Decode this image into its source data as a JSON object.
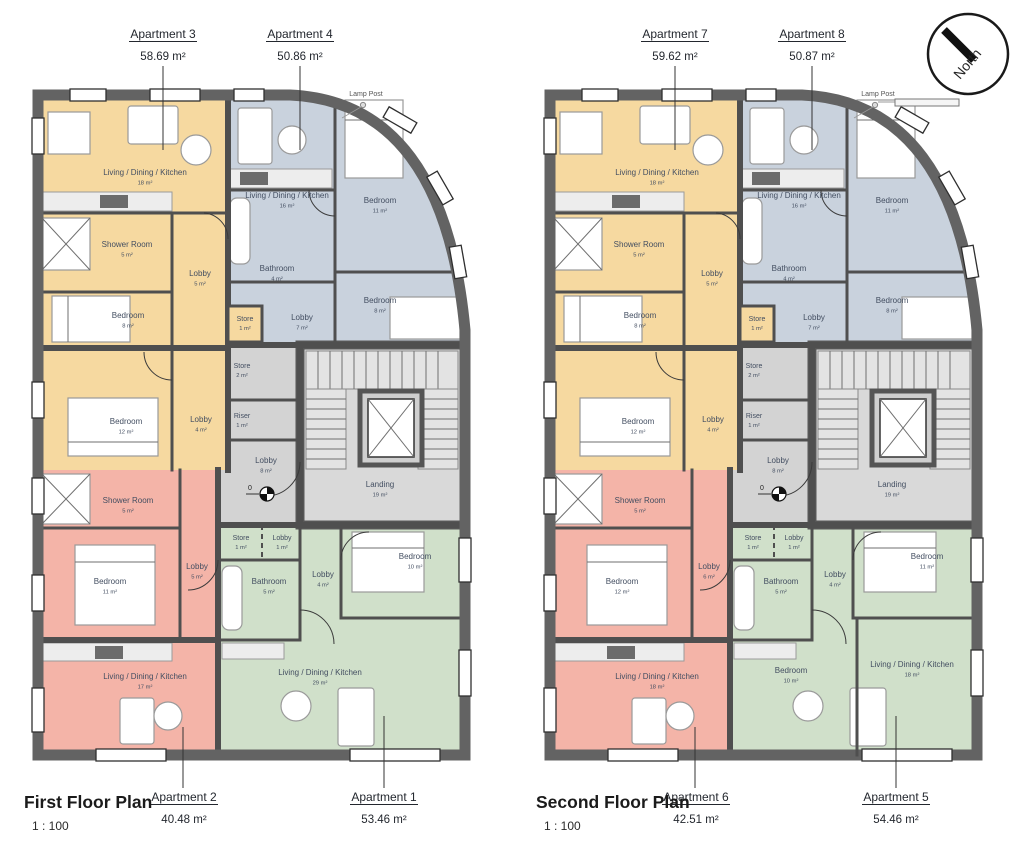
{
  "north_badge": {
    "label": "North"
  },
  "colors": {
    "apartment_yellow": "#F6D9A0",
    "apartment_blue": "#C9D2DD",
    "apartment_red": "#F4B4A8",
    "apartment_green": "#D0E0CA",
    "core_gray": "#D3D3D3",
    "exterior_wall": "#636363",
    "interior_wall": "#4F4F4F",
    "room_label_text": "#434E61",
    "callout_text": "#23272E"
  },
  "plans": [
    {
      "title": "First Floor Plan",
      "scale": "1 : 100",
      "lamp_post": "Lamp Post",
      "level_marker": "0",
      "callouts": {
        "top_left": {
          "name": "Apartment 3",
          "area": "58.69 m²"
        },
        "top_right": {
          "name": "Apartment 4",
          "area": "50.86 m²"
        },
        "bottom_left": {
          "name": "Apartment 2",
          "area": "40.48 m²"
        },
        "bottom_right": {
          "name": "Apartment 1",
          "area": "53.46 m²"
        }
      },
      "rooms": {
        "y_ldk": {
          "name": "Living / Dining / Kitchen",
          "area": "18 m²"
        },
        "y_shower": {
          "name": "Shower Room",
          "area": "5 m²"
        },
        "y_lobby_upper": {
          "name": "Lobby",
          "area": "5 m²"
        },
        "y_bed_small": {
          "name": "Bedroom",
          "area": "8 m²"
        },
        "y_bed_large": {
          "name": "Bedroom",
          "area": "12 m²"
        },
        "y_lobby_lower": {
          "name": "Lobby",
          "area": "4 m²"
        },
        "y_store": {
          "name": "Store",
          "area": "1 m²"
        },
        "b_ldk": {
          "name": "Living / Dining / Kitchen",
          "area": "16 m²"
        },
        "b_bed_front": {
          "name": "Bedroom",
          "area": "11 m²"
        },
        "b_bath": {
          "name": "Bathroom",
          "area": "4 m²"
        },
        "b_bed_rear": {
          "name": "Bedroom",
          "area": "8 m²"
        },
        "b_lobby": {
          "name": "Lobby",
          "area": "7 m²"
        },
        "c_store": {
          "name": "Store",
          "area": "2 m²"
        },
        "c_riser": {
          "name": "Riser",
          "area": "1 m²"
        },
        "c_lobby": {
          "name": "Lobby",
          "area": "8 m²"
        },
        "c_landing": {
          "name": "Landing",
          "area": "19 m²"
        },
        "r_shower": {
          "name": "Shower Room",
          "area": "5 m²"
        },
        "r_bed": {
          "name": "Bedroom",
          "area": "11 m²"
        },
        "r_lobby": {
          "name": "Lobby",
          "area": "5 m²"
        },
        "r_ldk": {
          "name": "Living / Dining / Kitchen",
          "area": "17 m²"
        },
        "g_store": {
          "name": "Store",
          "area": "1 m²"
        },
        "g_lobby_small": {
          "name": "Lobby",
          "area": "1 m²"
        },
        "g_bath": {
          "name": "Bathroom",
          "area": "5 m²"
        },
        "g_lobby": {
          "name": "Lobby",
          "area": "4 m²"
        },
        "g_bed_front": {
          "name": "Bedroom",
          "area": "10 m²"
        },
        "g_ldk_center": {
          "name": "Living / Dining / Kitchen",
          "area": "29 m²"
        }
      }
    },
    {
      "title": "Second Floor Plan",
      "scale": "1 : 100",
      "lamp_post": "Lamp Post",
      "lamp_post_bar": true,
      "level_marker": "0",
      "callouts": {
        "top_left": {
          "name": "Apartment 7",
          "area": "59.62 m²"
        },
        "top_right": {
          "name": "Apartment 8",
          "area": "50.87 m²"
        },
        "bottom_left": {
          "name": "Apartment 6",
          "area": "42.51 m²"
        },
        "bottom_right": {
          "name": "Apartment 5",
          "area": "54.46 m²"
        }
      },
      "rooms": {
        "y_ldk": {
          "name": "Living / Dining / Kitchen",
          "area": "18 m²"
        },
        "y_shower": {
          "name": "Shower Room",
          "area": "5 m²"
        },
        "y_lobby_upper": {
          "name": "Lobby",
          "area": "5 m²"
        },
        "y_bed_small": {
          "name": "Bedroom",
          "area": "8 m²"
        },
        "y_bed_large": {
          "name": "Bedroom",
          "area": "12 m²"
        },
        "y_lobby_lower": {
          "name": "Lobby",
          "area": "4 m²"
        },
        "y_store": {
          "name": "Store",
          "area": "1 m²"
        },
        "b_ldk": {
          "name": "Living / Dining / Kitchen",
          "area": "16 m²"
        },
        "b_bed_front": {
          "name": "Bedroom",
          "area": "11 m²"
        },
        "b_bath": {
          "name": "Bathroom",
          "area": "4 m²"
        },
        "b_bed_rear": {
          "name": "Bedroom",
          "area": "8 m²"
        },
        "b_lobby": {
          "name": "Lobby",
          "area": "7 m²"
        },
        "c_store": {
          "name": "Store",
          "area": "2 m²"
        },
        "c_riser": {
          "name": "Riser",
          "area": "1 m²"
        },
        "c_lobby": {
          "name": "Lobby",
          "area": "8 m²"
        },
        "c_landing": {
          "name": "Landing",
          "area": "19 m²"
        },
        "r_shower": {
          "name": "Shower Room",
          "area": "5 m²"
        },
        "r_bed": {
          "name": "Bedroom",
          "area": "12 m²"
        },
        "r_lobby": {
          "name": "Lobby",
          "area": "6 m²"
        },
        "r_ldk": {
          "name": "Living / Dining / Kitchen",
          "area": "18 m²"
        },
        "g_store": {
          "name": "Store",
          "area": "1 m²"
        },
        "g_lobby_small": {
          "name": "Lobby",
          "area": "1 m²"
        },
        "g_bath": {
          "name": "Bathroom",
          "area": "5 m²"
        },
        "g_lobby": {
          "name": "Lobby",
          "area": "4 m²"
        },
        "g_bed_front": {
          "name": "Bedroom",
          "area": "11 m²"
        },
        "g_bed_rear": {
          "name": "Bedroom",
          "area": "10 m²"
        },
        "g_ldk_right": {
          "name": "Living / Dining / Kitchen",
          "area": "18 m²"
        }
      }
    }
  ]
}
